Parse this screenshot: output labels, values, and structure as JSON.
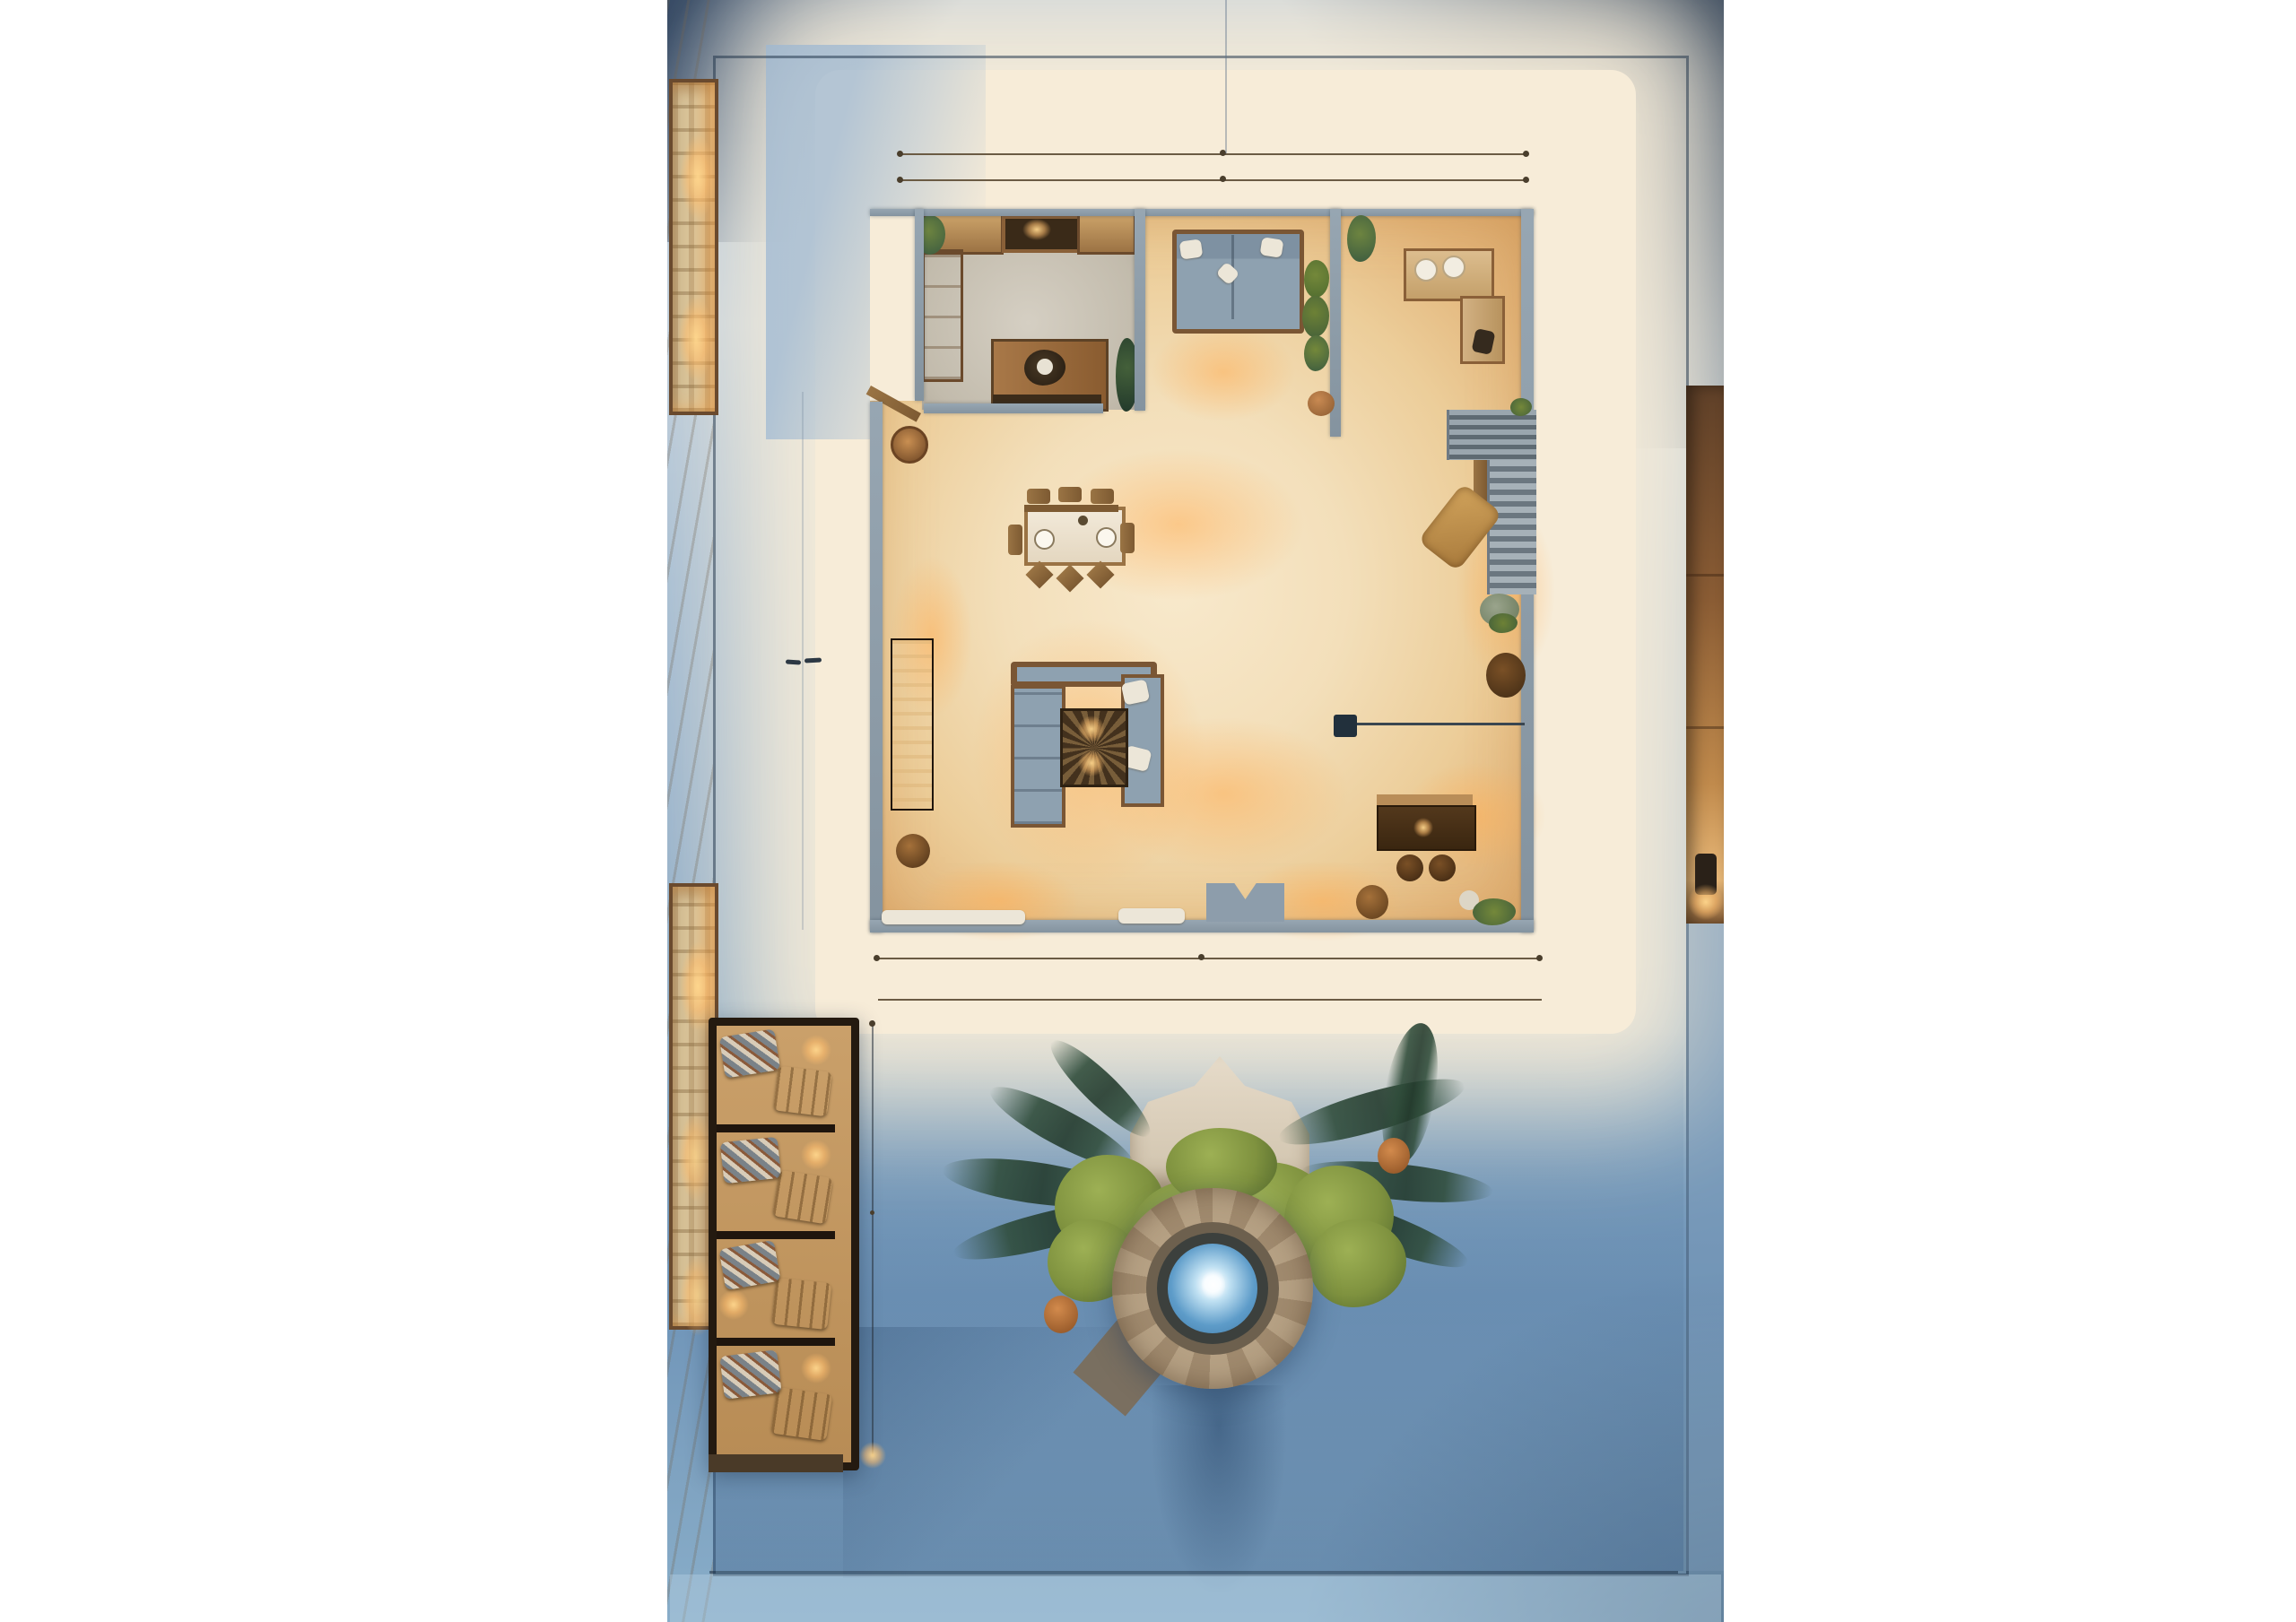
{
  "scene": {
    "description": "Top-down dusk aerial photograph of a modern cube house: warm amber-lit open interior at top with gray partition walls and wood furniture, surrounded by a glowing cream walkway with thin survey measurement lines, set in a light-blue walled courtyard; below is a circular stone fountain with glowing blue water flanked by green shrubs and dark palm fronds; a lit pillow shelf column stands on the left and warm stone niches line the far edges; dark navy shadows fill the corners.",
    "time_of_day": "dusk",
    "view": "top-down aerial"
  },
  "palette": {
    "page_bg": "#ffffff",
    "sky_top": "#b3c6da",
    "sky_mid": "#9db8d2",
    "courtyard_blue": "#7da2c2",
    "courtyard_deep": "#5f83a6",
    "shadow_navy": "#1c3a5e",
    "glow_cream": "#f7ecd8",
    "floor_warm": "#f2ddba",
    "floor_amber": "#e2b176",
    "wall_gray": "#8d9dab",
    "wood_dark": "#4a3018",
    "wood_mid": "#8a6038",
    "wood_light": "#c99e63",
    "cushion_white": "#ece6d8",
    "sofa_gray": "#8ea1b0",
    "leaf_green": "#7f923f",
    "leaf_dark": "#3a5a40",
    "palm_dark": "#2e4b39",
    "water_blue": "#5e9cc9",
    "water_light": "#eaf6fd",
    "terracotta": "#b5713b",
    "lamp_glow": "#ffd9a0",
    "stone_light": "#ded2bd",
    "stone_ring": "#b6a184",
    "tan_cushion": "#c59a62",
    "line_dark": "#6b5b44"
  },
  "regions": {
    "interior_rooms": [
      "lounge-room-with-sectional-and-coffee-table",
      "sofa-room-with-gray-loveseat",
      "office-room-with-l-desk"
    ],
    "interior_items": [
      "dining-table-six-chairs",
      "l-sectional-sofa",
      "sunburst-coffee-table-with-candles",
      "media-console",
      "staircase",
      "side-cabinet-with-stools",
      "double-door-swing-mark",
      "bench-cushions",
      "wall-pole-lamp",
      "round-stool",
      "wicker-sphere"
    ],
    "courtyard_items": [
      "circular-stone-fountain",
      "glowing-blue-water",
      "boxwood-shrubs",
      "palm-fronds",
      "terracotta-pots",
      "stone-gazebo-structure",
      "pillow-shelf-column",
      "hanging-cord-light",
      "survey-lines"
    ],
    "edge_items": [
      "left-stone-niches",
      "right-warm-niche-with-lamp",
      "parapet-outline",
      "corner-shadows"
    ]
  }
}
